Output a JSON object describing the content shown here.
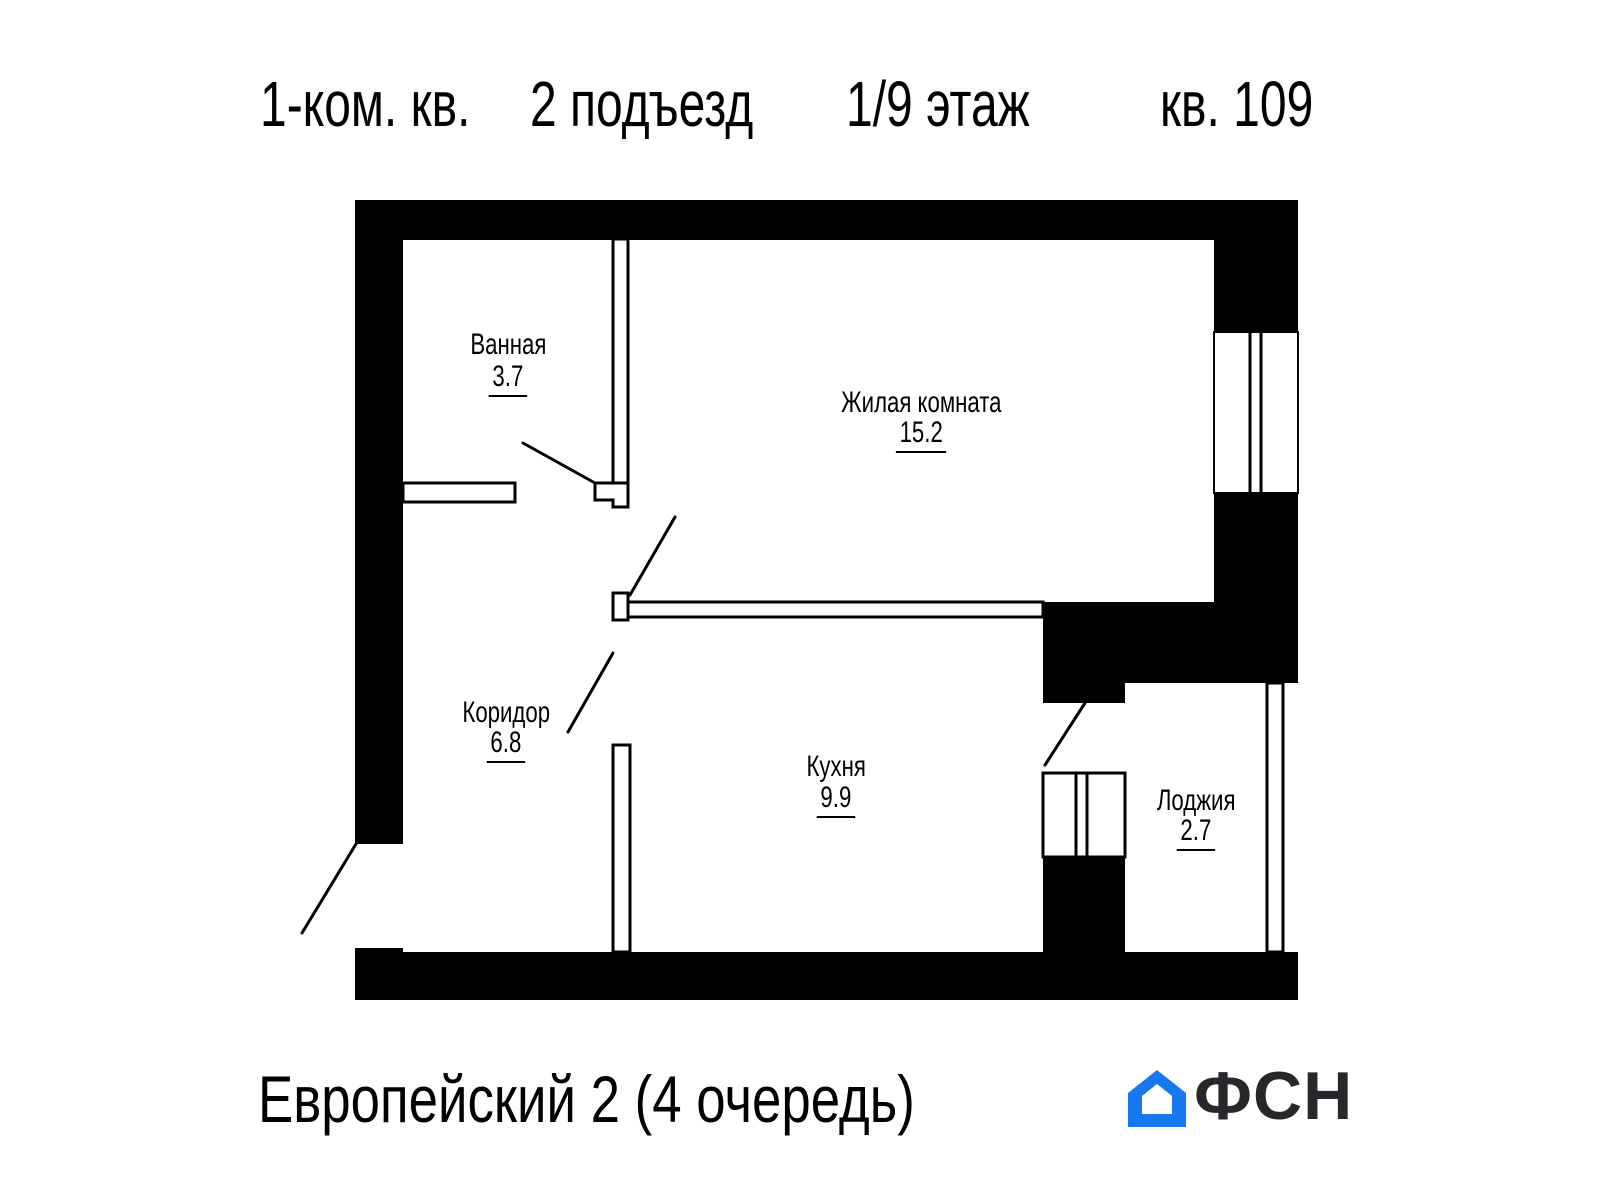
{
  "header": {
    "segments": [
      "1-ком. кв.",
      "2 подъезд",
      "1/9 этаж",
      "кв. 109"
    ]
  },
  "rooms": [
    {
      "name": "Ванная",
      "area": "3.7"
    },
    {
      "name": "Жилая комната",
      "area": "15.2"
    },
    {
      "name": "Коридор",
      "area": "6.8"
    },
    {
      "name": "Кухня",
      "area": "9.9"
    },
    {
      "name": "Лоджия",
      "area": "2.7"
    }
  ],
  "footer": {
    "project": "Европейский 2 (4 очередь)",
    "logo_text": "ФСН"
  },
  "icons": {
    "logo_house": "house-icon"
  },
  "colors": {
    "walls": "#000000",
    "logo_blue": "#1778f0",
    "logo_text": "#26282b"
  }
}
